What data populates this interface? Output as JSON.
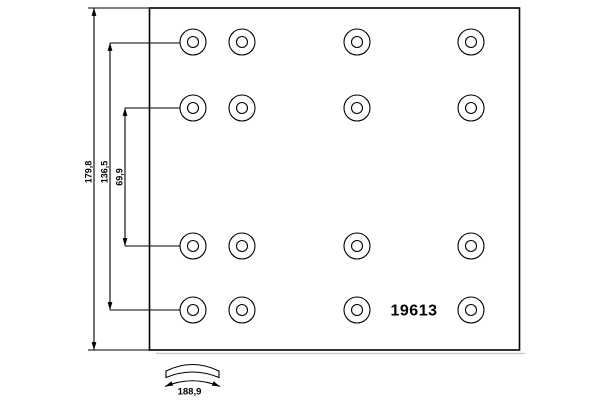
{
  "background_color": "#ffffff",
  "line_color": "#000000",
  "shadow_color": "#c9c9c9",
  "drawing": {
    "kind": "brake-lining-technical-drawing",
    "part_number": "19613",
    "dimensions": {
      "overall_height": "179,8",
      "outer_hole_rows_spacing": "136,5",
      "inner_hole_rows_spacing": "69,9",
      "lining_arc_width": "188,9"
    },
    "hole_grid": {
      "rows": 4,
      "columns": 4,
      "col_x": [
        193,
        242,
        357,
        471
      ],
      "row_y": [
        42,
        108,
        246,
        310
      ],
      "outer_radius": 13,
      "inner_radius": 5.5
    }
  }
}
